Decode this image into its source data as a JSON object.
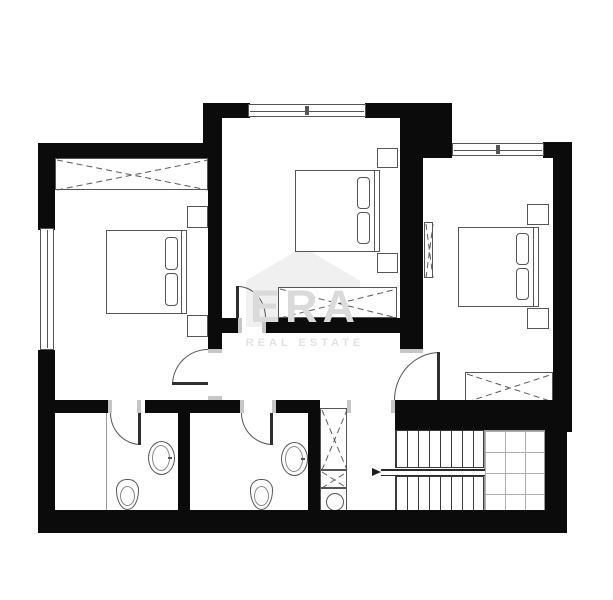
{
  "watermark": {
    "brand": "ERA",
    "tagline": "REAL ESTATE"
  },
  "colors": {
    "wall": "#0b0b0b",
    "furniture_line": "#555555",
    "fixture_line": "#888888",
    "door_jamb": "#c6c6c6",
    "watermark_house": "#f0f0f0",
    "watermark_brand_text": "#dadada",
    "watermark_tagline_text": "#e2e2e2",
    "floor": "#ffffff"
  },
  "plan": {
    "width": 613,
    "height": 600,
    "walls": [
      {
        "name": "outer-wall-west-upper",
        "r": [
          38,
          143,
          17,
          87
        ]
      },
      {
        "name": "outer-wall-west-lower",
        "r": [
          38,
          350,
          17,
          162
        ]
      },
      {
        "name": "outer-wall-north-left-bedroom",
        "r": [
          38,
          143,
          184,
          15
        ]
      },
      {
        "name": "wall-step-left-middle",
        "r": [
          203,
          103,
          19,
          55
        ]
      },
      {
        "name": "outer-wall-north-middle-west",
        "r": [
          222,
          103,
          28,
          15
        ]
      },
      {
        "name": "outer-wall-north-middle-east",
        "r": [
          365,
          103,
          47,
          15
        ]
      },
      {
        "name": "wall-corner-northeast-middle",
        "r": [
          400,
          103,
          52,
          55
        ]
      },
      {
        "name": "outer-wall-north-right-east",
        "r": [
          543,
          142,
          29,
          16
        ]
      },
      {
        "name": "outer-wall-east",
        "r": [
          553,
          142,
          19,
          290
        ]
      },
      {
        "name": "wall-left-bedroom-east",
        "r": [
          208,
          155,
          14,
          194
        ]
      },
      {
        "name": "wall-middle-bedroom-south-west",
        "r": [
          222,
          318,
          16,
          15
        ]
      },
      {
        "name": "wall-middle-bedroom-south-east",
        "r": [
          266,
          318,
          134,
          15
        ]
      },
      {
        "name": "wall-middle-right-divider",
        "r": [
          400,
          118,
          23,
          231
        ]
      },
      {
        "name": "wall-bathroom1-north-west",
        "r": [
          38,
          400,
          70,
          13
        ]
      },
      {
        "name": "wall-bathroom1-north-east",
        "r": [
          145,
          400,
          95,
          13
        ]
      },
      {
        "name": "wall-bathroom2-north-east",
        "r": [
          276,
          400,
          44,
          13
        ]
      },
      {
        "name": "wall-bathroom2-east",
        "r": [
          308,
          400,
          12,
          112
        ]
      },
      {
        "name": "wall-bathroom-divider",
        "r": [
          178,
          413,
          12,
          99
        ]
      },
      {
        "name": "wall-stair-north",
        "r": [
          395,
          400,
          177,
          30
        ]
      },
      {
        "name": "wall-stair-east",
        "r": [
          545,
          430,
          22,
          103
        ]
      },
      {
        "name": "outer-wall-south",
        "r": [
          38,
          510,
          529,
          23
        ]
      }
    ],
    "jambs": [
      {
        "r": [
          208,
          349,
          14,
          4
        ]
      },
      {
        "r": [
          208,
          396,
          14,
          4
        ]
      },
      {
        "r": [
          238,
          318,
          4,
          15
        ]
      },
      {
        "r": [
          262,
          318,
          4,
          15
        ]
      },
      {
        "r": [
          400,
          349,
          23,
          4
        ]
      },
      {
        "r": [
          108,
          400,
          4,
          13
        ]
      },
      {
        "r": [
          137,
          400,
          4,
          13
        ]
      },
      {
        "r": [
          240,
          400,
          4,
          13
        ]
      },
      {
        "r": [
          272,
          400,
          4,
          13
        ]
      },
      {
        "r": [
          347,
          400,
          4,
          13
        ]
      },
      {
        "r": [
          391,
          400,
          4,
          13
        ]
      }
    ],
    "windows": [
      {
        "name": "window-left-bedroom-west",
        "r": [
          40,
          228,
          14,
          122
        ],
        "orient": "v",
        "mullion": false
      },
      {
        "name": "window-middle-bedroom-north",
        "r": [
          248,
          104,
          118,
          13
        ],
        "orient": "h",
        "mullion": true
      },
      {
        "name": "window-right-bedroom-north",
        "r": [
          452,
          143,
          92,
          13
        ],
        "orient": "h",
        "mullion": true
      }
    ],
    "doors": [
      {
        "name": "door-left-bedroom",
        "box": [
          172,
          349,
          36,
          36
        ],
        "corner": "tl",
        "leaf": [
          172,
          382,
          36,
          3
        ]
      },
      {
        "name": "door-middle-bedroom",
        "box": [
          238,
          286,
          28,
          32
        ],
        "corner": "tr",
        "leaf": [
          236,
          286,
          3,
          32
        ]
      },
      {
        "name": "door-right-bedroom",
        "box": [
          394,
          352,
          46,
          48
        ],
        "corner": "tl",
        "leaf": [
          437,
          352,
          3,
          48
        ]
      },
      {
        "name": "door-bathroom-1",
        "box": [
          110,
          413,
          31,
          32
        ],
        "corner": "bl",
        "leaf": [
          138,
          413,
          3,
          32
        ]
      },
      {
        "name": "door-bathroom-2",
        "box": [
          241,
          413,
          32,
          32
        ],
        "corner": "bl",
        "leaf": [
          270,
          413,
          3,
          32
        ]
      }
    ],
    "beds": [
      {
        "name": "bed-left-bedroom",
        "frame": [
          106,
          230,
          76,
          84
        ],
        "headboard": [
          181,
          230,
          6,
          84
        ],
        "pillows": [
          [
            165,
            237,
            13,
            33
          ],
          [
            165,
            273,
            13,
            33
          ]
        ],
        "nightstands": [
          [
            187,
            206,
            21,
            22
          ],
          [
            187,
            315,
            21,
            22
          ]
        ]
      },
      {
        "name": "bed-middle-bedroom",
        "frame": [
          295,
          170,
          80,
          82
        ],
        "headboard": [
          374,
          170,
          6,
          82
        ],
        "pillows": [
          [
            357,
            177,
            13,
            32
          ],
          [
            357,
            212,
            13,
            32
          ]
        ],
        "nightstands": [
          [
            377,
            148,
            21,
            20
          ],
          [
            377,
            253,
            21,
            20
          ]
        ]
      },
      {
        "name": "bed-right-bedroom",
        "frame": [
          458,
          227,
          76,
          80
        ],
        "headboard": [
          533,
          227,
          6,
          80
        ],
        "pillows": [
          [
            516,
            233,
            13,
            32
          ],
          [
            516,
            268,
            13,
            32
          ]
        ],
        "nightstands": [
          [
            527,
            204,
            22,
            21
          ],
          [
            527,
            308,
            22,
            21
          ]
        ]
      }
    ],
    "wardrobes": [
      {
        "name": "wardrobe-left-bedroom",
        "r": [
          55,
          158,
          153,
          32
        ]
      },
      {
        "name": "wardrobe-middle-bedroom",
        "r": [
          278,
          287,
          119,
          31
        ]
      },
      {
        "name": "wardrobe-right-bedroom",
        "r": [
          465,
          372,
          88,
          30
        ]
      },
      {
        "name": "closet-hall-tall",
        "r": [
          320,
          408,
          27,
          62
        ]
      },
      {
        "name": "closet-hall-small",
        "r": [
          320,
          470,
          27,
          18
        ]
      },
      {
        "name": "radiator-right-bedroom",
        "r": [
          424,
          222,
          9,
          56
        ]
      }
    ],
    "fixtures": {
      "washer": {
        "name": "washing-machine",
        "r": [
          320,
          488,
          27,
          26
        ]
      },
      "sinks": [
        {
          "name": "sink-bathroom-1",
          "r": [
            148,
            441,
            27,
            34
          ]
        },
        {
          "name": "sink-bathroom-2",
          "r": [
            281,
            442,
            27,
            34
          ]
        }
      ],
      "toilets": [
        {
          "name": "toilet-bathroom-1",
          "r": [
            116,
            479,
            23,
            31
          ]
        },
        {
          "name": "toilet-bathroom-2",
          "r": [
            250,
            479,
            23,
            31
          ]
        }
      ],
      "partitions": [
        {
          "name": "shower-partition-bathroom-1",
          "r": [
            106,
            413,
            1,
            97
          ]
        }
      ]
    },
    "stairs": {
      "flights": [
        {
          "name": "stair-flight-upper",
          "r": [
            395,
            430,
            89,
            38
          ]
        },
        {
          "name": "stair-flight-lower",
          "r": [
            395,
            476,
            89,
            36
          ]
        }
      ],
      "rail": {
        "name": "stair-rail",
        "r": [
          381,
          469,
          104,
          7
        ]
      },
      "landing": {
        "name": "stair-landing",
        "r": [
          484,
          430,
          61,
          82
        ]
      },
      "arrow": {
        "name": "stair-direction-arrow",
        "x": 372,
        "y": 468
      }
    },
    "watermark_house": {
      "name": "era-house-logo",
      "r": [
        246,
        247,
        114,
        80
      ]
    }
  }
}
